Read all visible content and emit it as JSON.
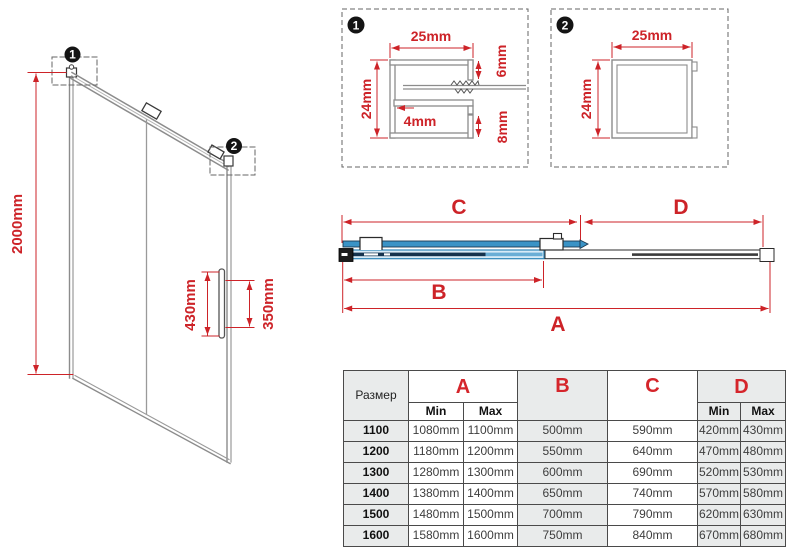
{
  "colors": {
    "dimension_red": "#cd2328",
    "profile_gray": "#8c8c8c",
    "dark_line": "#333333",
    "track_blue": "#3a93c6",
    "glass_navy": "#15334e",
    "table_gray": "#e9ebeb"
  },
  "door": {
    "height_label": "2000mm",
    "handle_length_label": "430mm",
    "handle_inner_label": "350mm",
    "callout1": "1",
    "callout2": "2"
  },
  "detail1": {
    "badge": "1",
    "width_label": "25mm",
    "height_label": "24mm",
    "slot_label": "4mm",
    "top_lip_label": "6mm",
    "bottom_lip_label": "8mm"
  },
  "detail2": {
    "badge": "2",
    "width_label": "25mm",
    "height_label": "24mm"
  },
  "plan": {
    "a": "A",
    "b": "B",
    "c": "C",
    "d": "D"
  },
  "table": {
    "size_header": "Размер",
    "col_a": "A",
    "col_b": "B",
    "col_c": "C",
    "col_d": "D",
    "min": "Min",
    "max": "Max",
    "rows": [
      {
        "size": "1100",
        "a_min": "1080mm",
        "a_max": "1100mm",
        "b": "500mm",
        "c": "590mm",
        "d_min": "420mm",
        "d_max": "430mm"
      },
      {
        "size": "1200",
        "a_min": "1180mm",
        "a_max": "1200mm",
        "b": "550mm",
        "c": "640mm",
        "d_min": "470mm",
        "d_max": "480mm"
      },
      {
        "size": "1300",
        "a_min": "1280mm",
        "a_max": "1300mm",
        "b": "600mm",
        "c": "690mm",
        "d_min": "520mm",
        "d_max": "530mm"
      },
      {
        "size": "1400",
        "a_min": "1380mm",
        "a_max": "1400mm",
        "b": "650mm",
        "c": "740mm",
        "d_min": "570mm",
        "d_max": "580mm"
      },
      {
        "size": "1500",
        "a_min": "1480mm",
        "a_max": "1500mm",
        "b": "700mm",
        "c": "790mm",
        "d_min": "620mm",
        "d_max": "630mm"
      },
      {
        "size": "1600",
        "a_min": "1580mm",
        "a_max": "1600mm",
        "b": "750mm",
        "c": "840mm",
        "d_min": "670mm",
        "d_max": "680mm"
      }
    ]
  }
}
